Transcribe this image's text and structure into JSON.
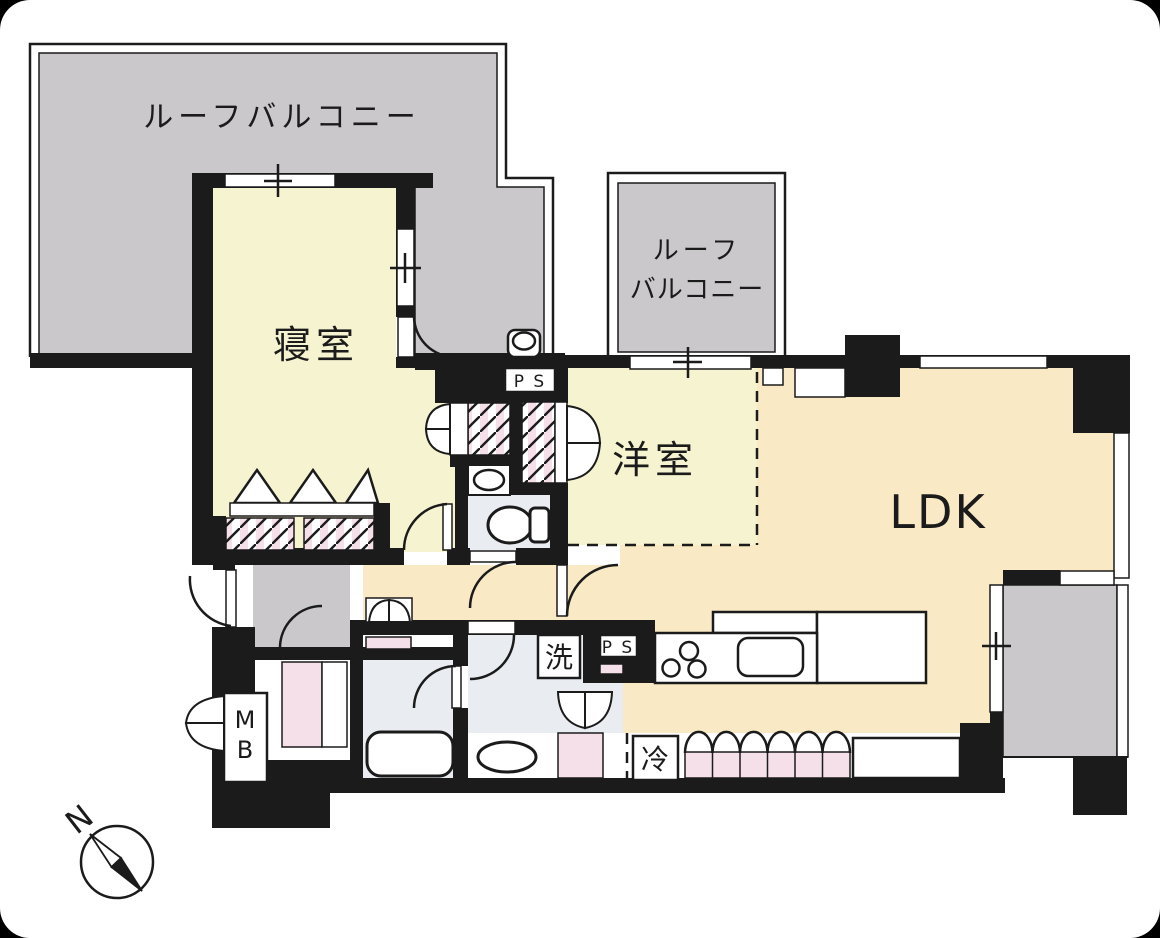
{
  "title": "apartment-floor-plan",
  "labels": {
    "roof_balcony_main": "ルーフバルコニー",
    "roof_balcony_2_line1": "ルーフ",
    "roof_balcony_2_line2": "バルコニー",
    "bedroom": "寝室",
    "western_room": "洋室",
    "ldk": "LDK",
    "washer": "洗",
    "pipe_space_1": "P S",
    "pipe_space_2": "P S",
    "fridge": "冷",
    "meter_box_line1": "M",
    "meter_box_line2": "B",
    "compass_north": "N"
  },
  "colors": {
    "wall": "#1b1b1b",
    "balcony_gray": "#cac8cb",
    "room_pale_yellow": "#f6f3d0",
    "floor_tan": "#f9e9c5",
    "wet_area_blue": "#e9edf2",
    "closet_pink": "#f5e0ea",
    "background": "#ffffff"
  }
}
